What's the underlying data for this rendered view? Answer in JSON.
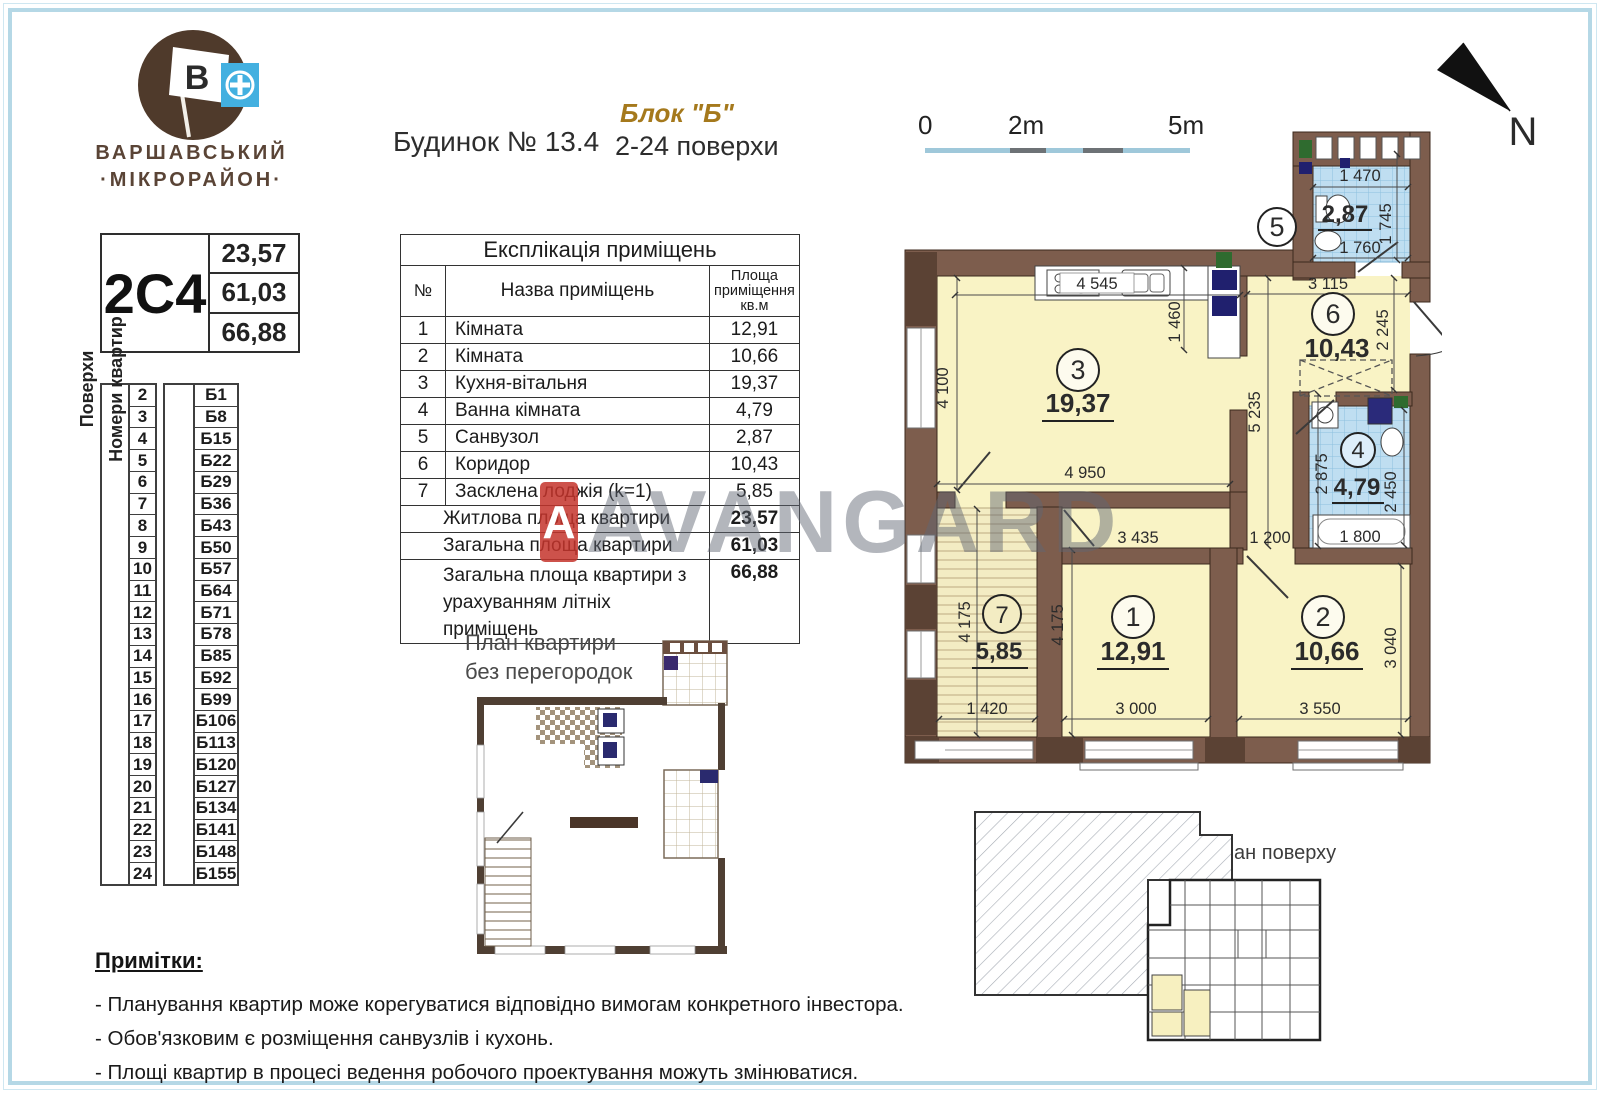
{
  "brand": {
    "line1": "ВАРШАВСЬКИЙ",
    "line2": "·МІКРОРАЙОН·",
    "flag_letter": "В"
  },
  "header": {
    "building": "Будинок № 13.4",
    "block": "Блок \"Б\"",
    "floors_range": "2-24 поверхи"
  },
  "unit_card": {
    "code": "2С4",
    "living_area": "23,57",
    "total_area": "61,03",
    "total_with_summer": "66,88"
  },
  "floors_table": {
    "floors_label": "Поверхи",
    "apartments_label": "Номери квартир",
    "rows": [
      {
        "floor": "2",
        "apt": "Б1"
      },
      {
        "floor": "3",
        "apt": "Б8"
      },
      {
        "floor": "4",
        "apt": "Б15"
      },
      {
        "floor": "5",
        "apt": "Б22"
      },
      {
        "floor": "6",
        "apt": "Б29"
      },
      {
        "floor": "7",
        "apt": "Б36"
      },
      {
        "floor": "8",
        "apt": "Б43"
      },
      {
        "floor": "9",
        "apt": "Б50"
      },
      {
        "floor": "10",
        "apt": "Б57"
      },
      {
        "floor": "11",
        "apt": "Б64"
      },
      {
        "floor": "12",
        "apt": "Б71"
      },
      {
        "floor": "13",
        "apt": "Б78"
      },
      {
        "floor": "14",
        "apt": "Б85"
      },
      {
        "floor": "15",
        "apt": "Б92"
      },
      {
        "floor": "16",
        "apt": "Б99"
      },
      {
        "floor": "17",
        "apt": "Б106"
      },
      {
        "floor": "18",
        "apt": "Б113"
      },
      {
        "floor": "19",
        "apt": "Б120"
      },
      {
        "floor": "20",
        "apt": "Б127"
      },
      {
        "floor": "21",
        "apt": "Б134"
      },
      {
        "floor": "22",
        "apt": "Б141"
      },
      {
        "floor": "23",
        "apt": "Б148"
      },
      {
        "floor": "24",
        "apt": "Б155"
      }
    ]
  },
  "explication": {
    "title": "Експлікація приміщень",
    "col_num": "№",
    "col_name": "Назва приміщень",
    "col_area": "Площа приміщення кв.м",
    "rows": [
      {
        "num": "1",
        "name": "Кімната",
        "area": "12,91"
      },
      {
        "num": "2",
        "name": "Кімната",
        "area": "10,66"
      },
      {
        "num": "3",
        "name": "Кухня-вітальня",
        "area": "19,37"
      },
      {
        "num": "4",
        "name": "Ванна кімната",
        "area": "4,79"
      },
      {
        "num": "5",
        "name": "Санвузол",
        "area": "2,87"
      },
      {
        "num": "6",
        "name": "Коридор",
        "area": "10,43"
      },
      {
        "num": "7",
        "name": "Засклена лоджія (k=1)",
        "area": "5,85"
      }
    ],
    "totals": [
      {
        "name": "Житлова площа квартири",
        "area": "23,57"
      },
      {
        "name": "Загальна площа квартири",
        "area": "61,03"
      },
      {
        "name": "Загальна площа квартири з урахуванням літніх приміщень",
        "area": "66,88"
      }
    ]
  },
  "scale_bar": {
    "t0": "0",
    "t2": "2m",
    "t5": "5m"
  },
  "compass": {
    "label": "N"
  },
  "plan": {
    "rooms": [
      {
        "num": "1",
        "area": "12,91"
      },
      {
        "num": "2",
        "area": "10,66"
      },
      {
        "num": "3",
        "area": "19,37"
      },
      {
        "num": "4",
        "area": "4,79"
      },
      {
        "num": "5",
        "area": "2,87"
      },
      {
        "num": "6",
        "area": "10,43"
      },
      {
        "num": "7",
        "area": "5,85"
      }
    ],
    "dims": [
      "4 545",
      "1 460",
      "4 100",
      "4 950",
      "5 235",
      "3 435",
      "1 200",
      "3 115",
      "2 245",
      "1 470",
      "1 745",
      "1 760",
      "2 875",
      "2 450",
      "1 800",
      "4 175",
      "4 175",
      "1 420",
      "3 000",
      "3 550",
      "3 040"
    ]
  },
  "secondary_plan": {
    "label_line1": "План квартири",
    "label_line2": "без перегородок"
  },
  "floor_overview": {
    "label": "План поверху"
  },
  "notes": {
    "title": "Примітки:",
    "items": [
      "- Планування квартир може корегуватися відповідно вимогам конкретного інвестора.",
      "- Обов'язковим є розміщення санвузлів і кухонь.",
      "- Площі квартир в процесі ведення робочого проектування можуть змінюватися."
    ]
  },
  "watermark": {
    "text": "AVANGARD",
    "badge_letter": "А",
    "accent_color": "#c4342c"
  }
}
